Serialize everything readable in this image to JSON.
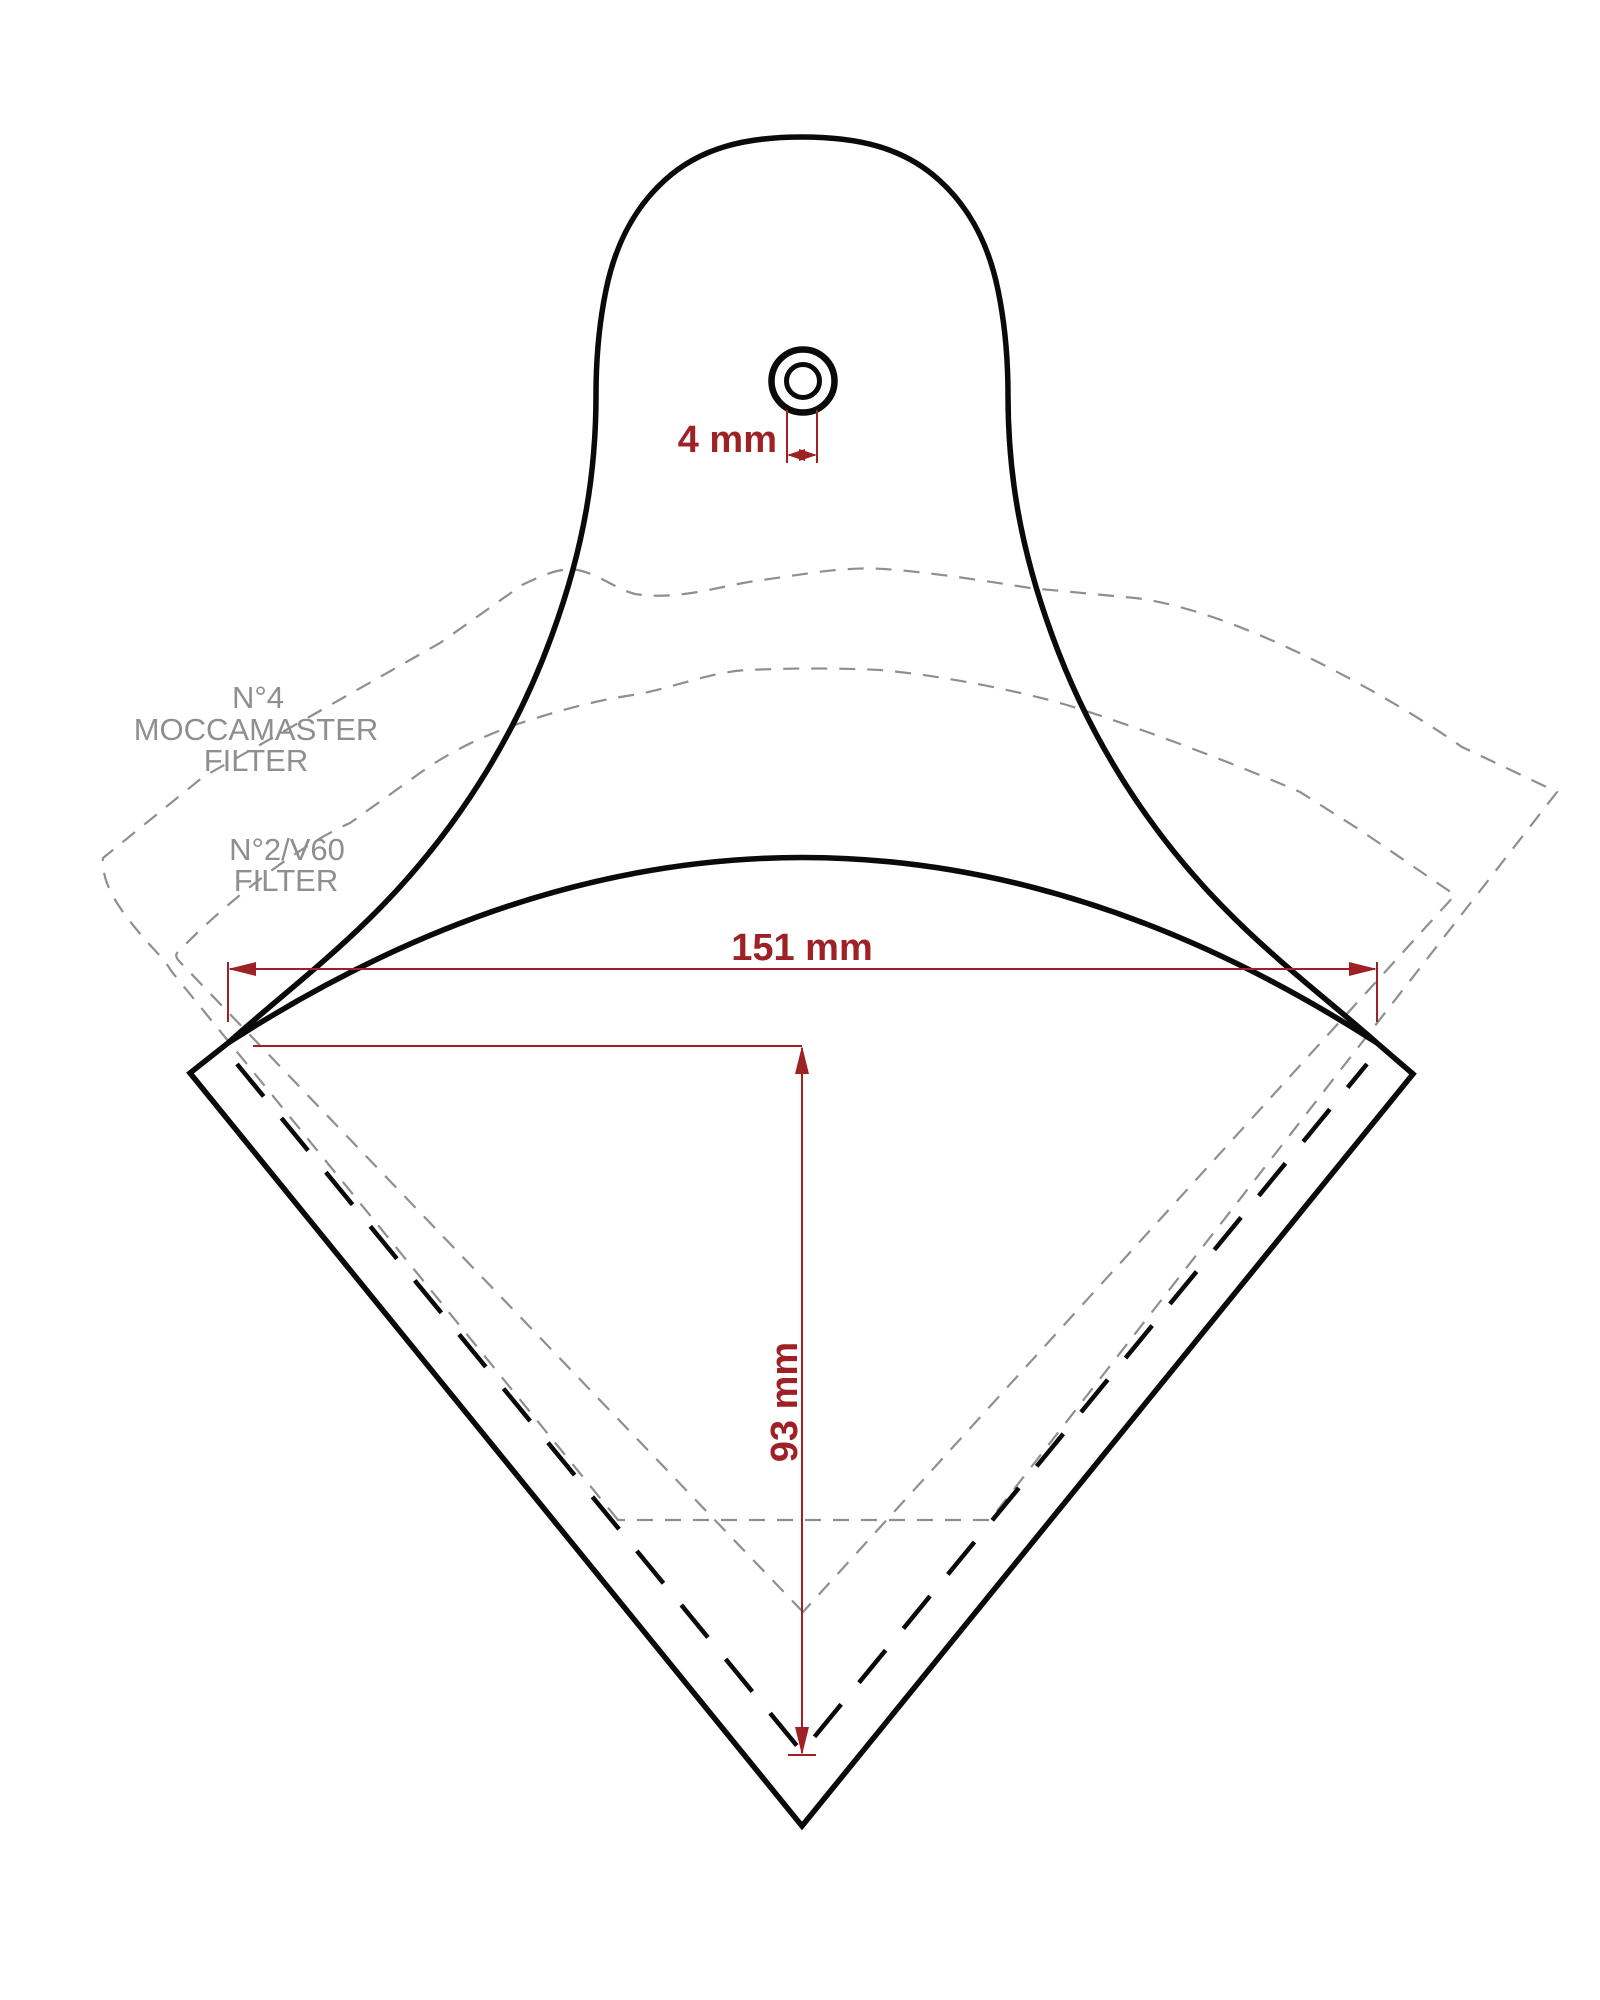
{
  "diagram": {
    "reference_filters": {
      "moccamaster": {
        "line1": "N°4",
        "line2": "MOCCAMASTER",
        "line3": "FILTER"
      },
      "v60": {
        "line1": "N°2/V60",
        "line2": "FILTER"
      }
    },
    "dimensions": {
      "hole_diameter": "4 mm",
      "top_width": "151 mm",
      "pocket_depth": "93 mm"
    },
    "colors": {
      "dimension_red": "#9e2126",
      "outline_black": "#0a0a0a",
      "reference_gray": "#8f8f8f",
      "background": "#ffffff"
    }
  }
}
